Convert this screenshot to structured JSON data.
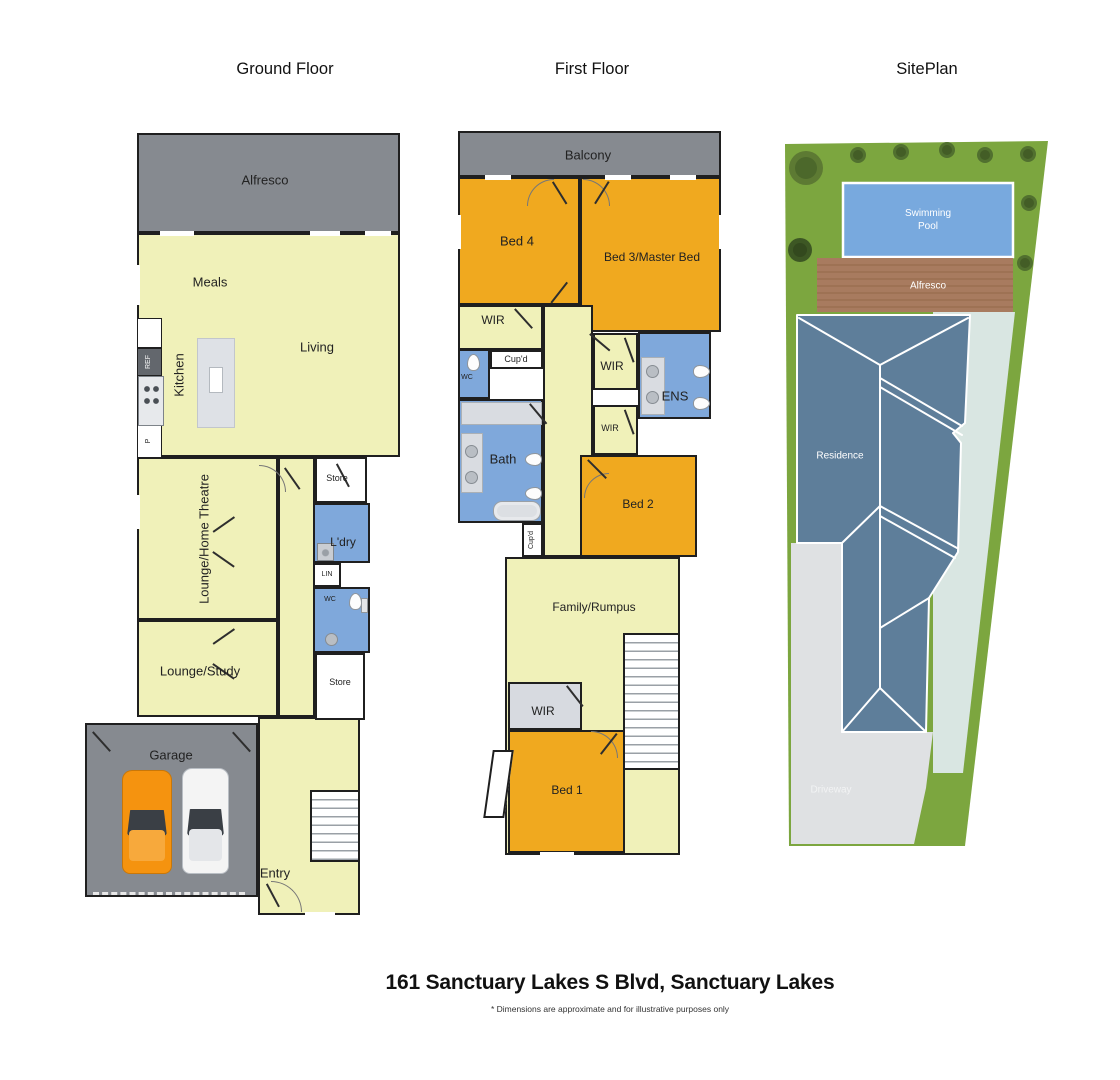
{
  "titles": {
    "ground_floor": "Ground Floor",
    "first_floor": "First Floor",
    "site_plan": "SitePlan"
  },
  "footer": {
    "address": "161 Sanctuary Lakes S Blvd, Sanctuary Lakes",
    "disclaimer": "* Dimensions are approximate and for illustrative purposes only"
  },
  "ground_floor": {
    "alfresco": "Alfresco",
    "meals": "Meals",
    "living": "Living",
    "kitchen": "Kitchen",
    "ref": "REF",
    "pantry": "P",
    "store_upper": "Store",
    "laundry": "L'dry",
    "linen": "LIN",
    "wc": "WC",
    "store_lower": "Store",
    "lounge_home_theatre": "Lounge/Home Theatre",
    "lounge_study": "Lounge/Study",
    "garage": "Garage",
    "entry": "Entry"
  },
  "first_floor": {
    "balcony": "Balcony",
    "bed4": "Bed 4",
    "bed3": "Bed 3/Master Bed",
    "wir_bed4": "WIR",
    "cupboard_hall": "Cup'd",
    "wc": "WC",
    "bath": "Bath",
    "wir_master": "WIR",
    "ensuite": "ENS",
    "wir_bed2": "WIR",
    "bed2": "Bed 2",
    "cupboard_bath": "Cup'd",
    "family_rumpus": "Family/Rumpus",
    "wir_bed1": "WIR",
    "bed1": "Bed 1"
  },
  "site_plan": {
    "swimming_pool": "Swimming Pool",
    "alfresco": "Alfresco",
    "residence": "Residence",
    "driveway": "Driveway"
  },
  "colors": {
    "room_yellow": "#F0F1B9",
    "bedroom_orange": "#F0A91F",
    "wet_area_blue": "#7FA8DB",
    "outdoor_grey": "#868A90",
    "grass_green": "#7CA63F",
    "pool_blue": "#78A9DE",
    "deck_brown": "#A87B5F",
    "roof_slate": "#5E7E9A",
    "driveway_grey": "#DFE1E3",
    "car_orange": "#F5930F",
    "wall_black": "#1F1F1F"
  }
}
